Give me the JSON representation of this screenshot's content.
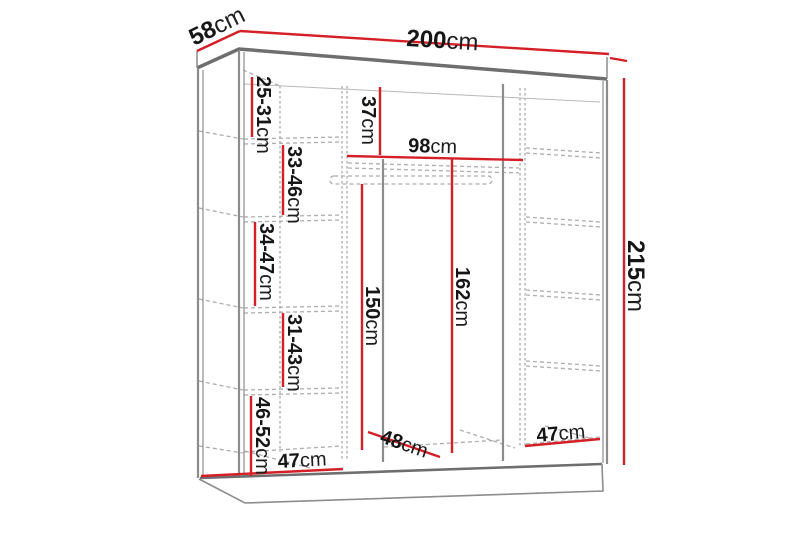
{
  "diagram": {
    "title": "wardrobe-dimension-diagram",
    "unit": "cm",
    "colors": {
      "dimension_line": "#d51f26",
      "outline": "#6e6e6e",
      "dashed_guides": "#adadad",
      "label_text": "#161616",
      "background": "#ffffff"
    },
    "dims": {
      "overall_depth": {
        "value": "58",
        "unit": "cm"
      },
      "overall_width": {
        "value": "200",
        "unit": "cm"
      },
      "overall_height": {
        "value": "215",
        "unit": "cm"
      },
      "left_gap_1": {
        "value": "25-31",
        "unit": "cm"
      },
      "left_gap_2": {
        "value": "33-46",
        "unit": "cm"
      },
      "left_gap_3": {
        "value": "34-47",
        "unit": "cm"
      },
      "left_gap_4": {
        "value": "31-43",
        "unit": "cm"
      },
      "left_gap_5": {
        "value": "46-52",
        "unit": "cm"
      },
      "top_compartment": {
        "value": "37",
        "unit": "cm"
      },
      "middle_inner_width": {
        "value": "98",
        "unit": "cm"
      },
      "hanging_height": {
        "value": "150",
        "unit": "cm"
      },
      "middle_height": {
        "value": "162",
        "unit": "cm"
      },
      "middle_depth": {
        "value": "48",
        "unit": "cm"
      },
      "bottom_left_width": {
        "value": "47",
        "unit": "cm"
      },
      "bottom_right_width": {
        "value": "47",
        "unit": "cm"
      }
    }
  }
}
